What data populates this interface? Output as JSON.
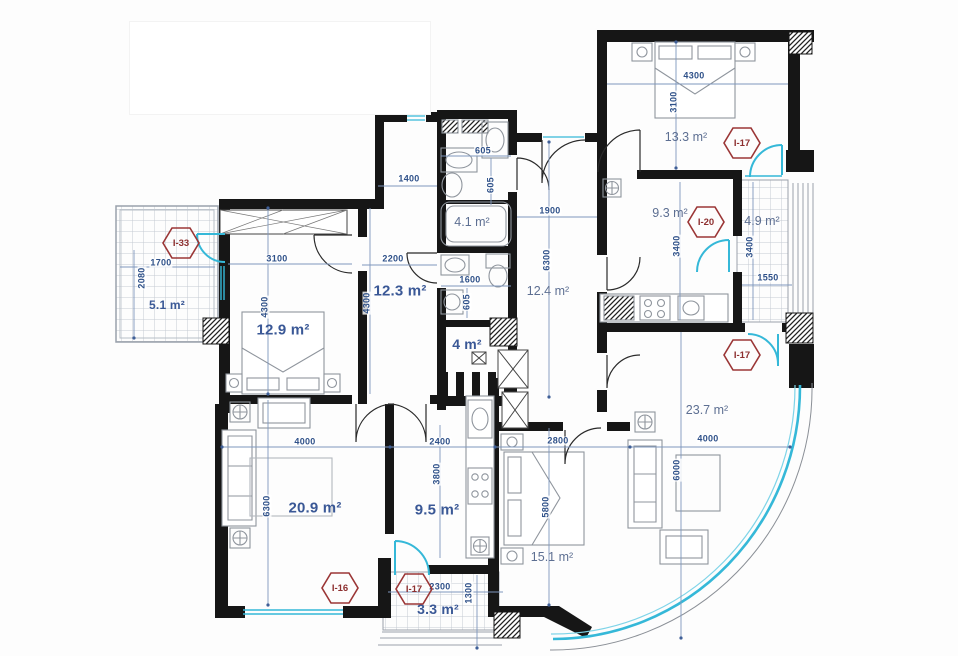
{
  "page": {
    "title": "Apartment floor plan"
  },
  "colors": {
    "wall": "#161616",
    "dimension_text": "#2f5189",
    "dimension_line": "#7e97bd",
    "room_label": "#3a5896",
    "room_label_light": "#5d6f92",
    "unit_marker": "#9b3636",
    "glazing": "#35b8d8",
    "furniture": "#8f959d"
  },
  "rooms": [
    {
      "name": "balcony-top-left",
      "area": "5.1 m²"
    },
    {
      "name": "bedroom-left",
      "area": "12.9 m²"
    },
    {
      "name": "hallway-upper",
      "area": "12.3 m²"
    },
    {
      "name": "bathroom",
      "area": "4.1 m²"
    },
    {
      "name": "storage",
      "area": "4 m²"
    },
    {
      "name": "hallway-right",
      "area": "12.4 m²"
    },
    {
      "name": "bedroom-top-right",
      "area": "13.3 m²"
    },
    {
      "name": "kitchen-right",
      "area": "9.3 m²"
    },
    {
      "name": "balcony-right",
      "area": "4.9 m²"
    },
    {
      "name": "living-room-right",
      "area": "23.7 m²"
    },
    {
      "name": "living-room-left",
      "area": "20.9 m²"
    },
    {
      "name": "kitchen-left",
      "area": "9.5 m²"
    },
    {
      "name": "bedroom-bottom",
      "area": "15.1 m²"
    },
    {
      "name": "balcony-bottom",
      "area": "3.3 m²"
    }
  ],
  "markers": [
    {
      "label": "I-33"
    },
    {
      "label": "I-17"
    },
    {
      "label": "I-20"
    },
    {
      "label": "I-17"
    },
    {
      "label": "I-16"
    },
    {
      "label": "I-17"
    }
  ],
  "dimensions": [
    {
      "value": "1400"
    },
    {
      "value": "1700"
    },
    {
      "value": "2080"
    },
    {
      "value": "3100"
    },
    {
      "value": "4300"
    },
    {
      "value": "2200"
    },
    {
      "value": "4300"
    },
    {
      "value": "605"
    },
    {
      "value": "605"
    },
    {
      "value": "1600"
    },
    {
      "value": "605"
    },
    {
      "value": "1900"
    },
    {
      "value": "6300"
    },
    {
      "value": "4300"
    },
    {
      "value": "3100"
    },
    {
      "value": "3400"
    },
    {
      "value": "3400"
    },
    {
      "value": "1550"
    },
    {
      "value": "4000"
    },
    {
      "value": "6000"
    },
    {
      "value": "4000"
    },
    {
      "value": "6300"
    },
    {
      "value": "2400"
    },
    {
      "value": "3800"
    },
    {
      "value": "2800"
    },
    {
      "value": "5800"
    },
    {
      "value": "2300"
    },
    {
      "value": "1300"
    }
  ]
}
